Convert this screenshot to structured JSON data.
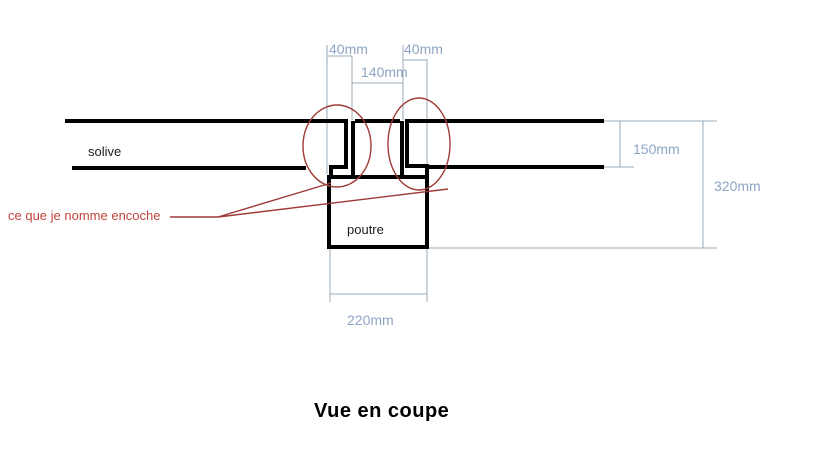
{
  "diagram": {
    "title": "Vue en coupe",
    "parts": {
      "joist_label": "solive",
      "beam_label": "poutre"
    },
    "annotation": {
      "text": "ce que je nomme encoche"
    },
    "dimensions": {
      "left_notch_width": "40mm",
      "spacing_between_notches": "140mm",
      "right_notch_width": "40mm",
      "joist_height": "150mm",
      "overall_height": "320mm",
      "beam_width": "220mm"
    },
    "colors": {
      "drawing_line": "#000000",
      "dimension_line": "#9aa8ba",
      "dimension_text": "#8ea4c4",
      "annotation_text": "#c0453e",
      "highlight_red": "#9e3b38",
      "background": "#ffffff"
    }
  }
}
